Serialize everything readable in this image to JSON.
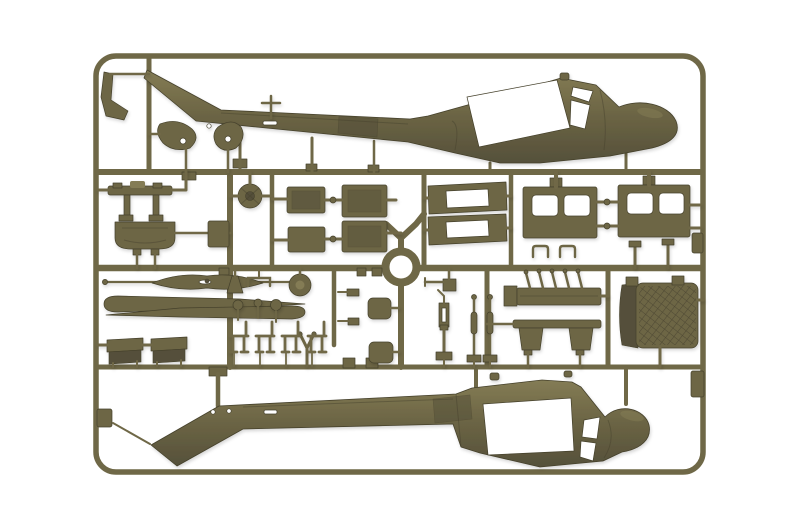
{
  "scene": {
    "type": "product-photo",
    "description": "Olive drab injection-moulded plastic model kit sprue (UH-1 Huey helicopter) on a white background: two fuselage halves with open cabin cut-outs, cargo and pilot doors with window openings, cabin panels, rotor hub, stabilizer bar, rotor blades, bench and crew seats, shock struts, skid parts, engine deck and a cross-hatched engine intake screen, all attached to a rounded rectangular runner frame.",
    "background_color_name": "white",
    "object_color_name": "olive drab"
  },
  "palette": {
    "bg": "#ffffff",
    "sprue": "#6f6847",
    "olive": "#6d6645",
    "olive-light": "#847c55",
    "olive-dark": "#55503a",
    "olive-deep": "#45412c",
    "mesh-line": "#4a4531",
    "cutout": "#ffffff"
  },
  "parts_inventory": [
    "sprue frame",
    "upper fuselage half",
    "lower fuselage half",
    "tail skid",
    "stabilizer paddle left",
    "stabilizer paddle right",
    "pitot cross part",
    "rotor head assembly",
    "intake cowl",
    "rotor hub disc",
    "cabin panel x4",
    "floor panel",
    "pilot door x2",
    "cargo door x2",
    "door hinge bracket x2",
    "stabilizer bar",
    "main rotor blade x2",
    "bench seat x2",
    "wishbone strut",
    "exhaust bell",
    "staple bracket",
    "wheel disc",
    "control knob x3",
    "crew seat frame x4",
    "clamp x2",
    "rounded plate x2",
    "antenna arm",
    "shock strut",
    "tie rod x2",
    "engine tray",
    "bench frame",
    "engine intake mesh screen",
    "center ring"
  ]
}
